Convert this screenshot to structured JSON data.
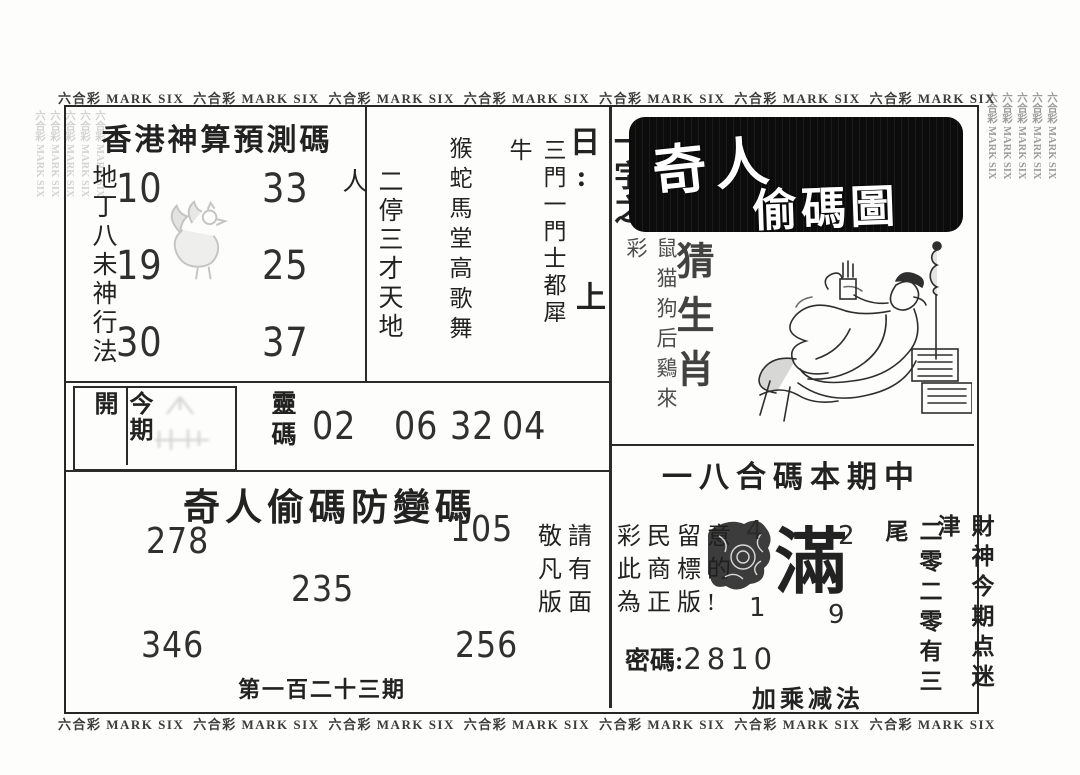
{
  "border": {
    "text": "六合彩 MARK SIX",
    "top": [
      "六合彩 MARK SIX",
      "六合彩 MARK SIX",
      "六合彩 MARK SIX",
      "六合彩 MARK SIX",
      "六合彩 MARK SIX",
      "六合彩 MARK SIX",
      "六合彩 MARK SIX"
    ],
    "bottom": [
      "六合彩 MARK SIX",
      "六合彩 MARK SIX",
      "六合彩 MARK SIX",
      "六合彩 MARK SIX",
      "六合彩 MARK SIX",
      "六合彩 MARK SIX",
      "六合彩 MARK SIX"
    ],
    "left": [
      "六合彩 MARK SIX",
      "六合彩 MARK SIX",
      "六合彩 MARK SIX",
      "六合彩 MARK SIX",
      "六合彩 MARK SIX"
    ],
    "right": [
      "六合彩 MARK SIX",
      "六合彩 MARK SIX",
      "六合彩 MARK SIX",
      "六合彩 MARK SIX",
      "六合彩 MARK SIX"
    ]
  },
  "prediction_box": {
    "title": "香港神算預測碼",
    "method_left": "地丁八未神行法",
    "method_right": "二停三才天地人",
    "numbers_col1": [
      "10",
      "19",
      "30"
    ],
    "numbers_col2": [
      "33",
      "25",
      "37"
    ]
  },
  "verse_panel": {
    "line1": "一字之日:",
    "line1_answer": "上",
    "line2": "三門一門士都犀牛",
    "line3": "猴蛇馬堂高歌舞"
  },
  "current_draw": {
    "label": "今期開",
    "code_label": "靈碼",
    "codes": [
      "02",
      "06",
      "32",
      "04"
    ]
  },
  "anti_change": {
    "title": "奇人偷碼防變碼",
    "numbers": {
      "top_left": "278",
      "top_right": "105",
      "center": "235",
      "bottom_left": "346",
      "bottom_right": "256"
    },
    "issue": "第一百二十三期"
  },
  "notice": {
    "rows_left": [
      "敬請",
      "凡有",
      "版面"
    ],
    "rows_right": [
      "彩民留意",
      "此商標的",
      "為正版!"
    ]
  },
  "master_panel": {
    "title_top": "奇人",
    "title_bottom": "偷碼圖",
    "guess": "猜生肖",
    "zodiac_hint": "鼠猫狗后鷄來彩",
    "hit_line": "一八合碼本期中",
    "seal_char": "滿",
    "seal_numbers": {
      "top_left": "4",
      "top_right": "2",
      "bottom_left": "1",
      "bottom_right": "9"
    },
    "password_label": "密碼:",
    "password_value": "2810",
    "method": "加乘减法",
    "tail_hint": "二零二零有三尾",
    "god_hint": "財神今期点迷津"
  },
  "icons": {
    "rooster": "rooster-line-art",
    "scholar": "reclining-scholar-drawing",
    "seal": "ink-stamp",
    "faded": "faded-print"
  }
}
